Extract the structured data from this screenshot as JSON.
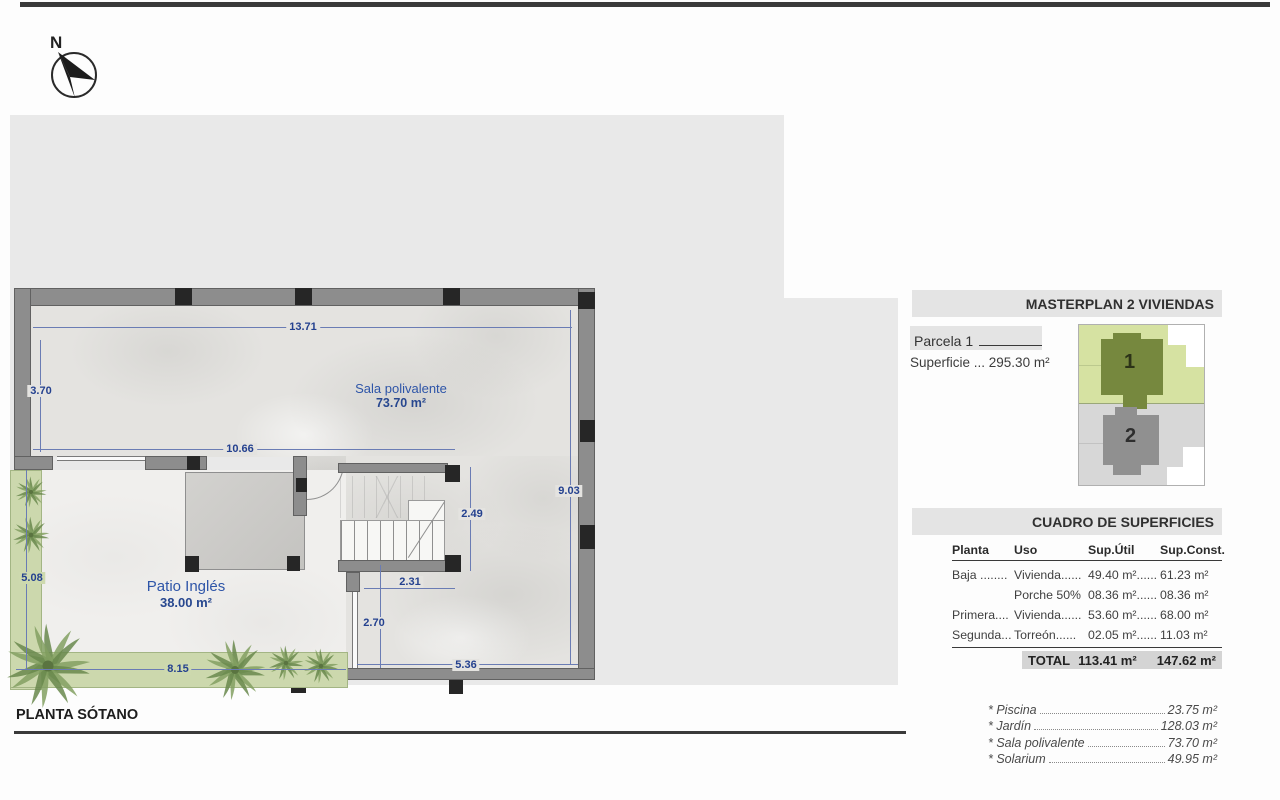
{
  "plan": {
    "name": "PLANTA SÓTANO",
    "north_label": "N",
    "rooms": {
      "sala": {
        "name": "Sala polivalente",
        "area": "73.70 m²"
      },
      "patio": {
        "name": "Patio Inglés",
        "area": "38.00 m²"
      }
    },
    "dimensions": {
      "top": "13.71",
      "left_upper": "3.70",
      "inner_width": "10.66",
      "right": "9.03",
      "stair_h": "2.49",
      "stair_w": "2.31",
      "window": "2.70",
      "bottom_right": "5.36",
      "garden_left": "5.08",
      "garden_bottom": "8.15"
    }
  },
  "masterplan": {
    "title": "MASTERPLAN 2 VIVIENDAS",
    "parcela_label": "Parcela 1",
    "superficie": "Superficie ... 295.30 m²",
    "site": {
      "house1": "1",
      "house2": "2"
    }
  },
  "cuadro": {
    "title": "CUADRO DE SUPERFICIES",
    "headers": {
      "planta": "Planta",
      "uso": "Uso",
      "util": "Sup.Útil",
      "const": "Sup.Const."
    },
    "rows": [
      {
        "planta": "Baja ........",
        "uso": "Vivienda......",
        "util": "49.40 m²......",
        "const": "61.23 m²"
      },
      {
        "planta": "",
        "uso": "Porche 50%",
        "util": "08.36 m²......",
        "const": "08.36 m²"
      },
      {
        "planta": "Primera....",
        "uso": "Vivienda......",
        "util": "53.60 m²......",
        "const": "68.00 m²"
      },
      {
        "planta": "Segunda...",
        "uso": "Torreón......",
        "util": "02.05 m²......",
        "const": "11.03 m²"
      }
    ],
    "total": {
      "label": "TOTAL",
      "util": "113.41 m²",
      "const": "147.62 m²"
    }
  },
  "extras": [
    {
      "name": "* Piscina",
      "value": "23.75 m²"
    },
    {
      "name": "* Jardín",
      "value": "128.03 m²"
    },
    {
      "name": "* Sala polivalente",
      "value": "73.70 m²"
    },
    {
      "name": "* Solarium",
      "value": "49.95 m²"
    }
  ],
  "colors": {
    "accent_blue": "#24418f",
    "parcel_green": "#d6e2a2",
    "house1_green": "#76883e",
    "house2_gray": "#909090"
  }
}
